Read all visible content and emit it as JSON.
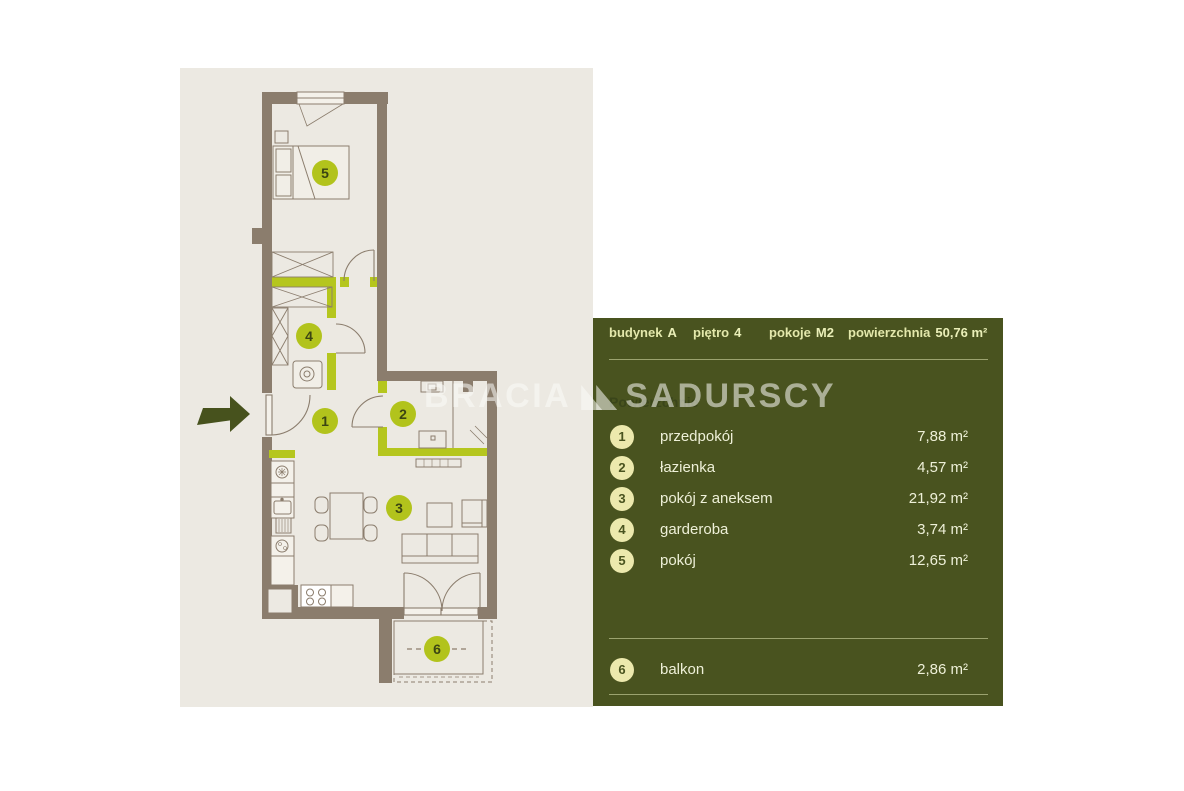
{
  "watermark": {
    "brand_left": "BRACIA",
    "brand_right": "SADURSCY"
  },
  "colors": {
    "panel_green": "#49531f",
    "plan_beige": "#ece9e2",
    "wall_brown": "#8b7d6d",
    "accent_lime": "#b5c61e",
    "badge_cream": "#ece9ad",
    "panel_text": "#eef0d8",
    "arrow_olive": "#47521d"
  },
  "panel": {
    "header": [
      {
        "label": "budynek",
        "value": "A"
      },
      {
        "label": "piętro",
        "value": "4"
      },
      {
        "label": "pokoje",
        "value": "M2"
      },
      {
        "label": "powierzchnia",
        "value": "50,76 m²"
      }
    ],
    "section_label": "Powierzchnie",
    "rooms": [
      {
        "number": "1",
        "name": "przedpokój",
        "area": "7,88 m²"
      },
      {
        "number": "2",
        "name": "łazienka",
        "area": "4,57 m²"
      },
      {
        "number": "3",
        "name": "pokój z aneksem",
        "area": "21,92 m²"
      },
      {
        "number": "4",
        "name": "garderoba",
        "area": "3,74 m²"
      },
      {
        "number": "5",
        "name": "pokój",
        "area": "12,65 m²"
      }
    ],
    "balcony_row": {
      "number": "6",
      "name": "balkon",
      "area": "2,86 m²"
    }
  },
  "floor_plan": {
    "markers": [
      {
        "label": "1"
      },
      {
        "label": "2"
      },
      {
        "label": "3"
      },
      {
        "label": "4"
      },
      {
        "label": "5"
      },
      {
        "label": "6"
      }
    ]
  }
}
